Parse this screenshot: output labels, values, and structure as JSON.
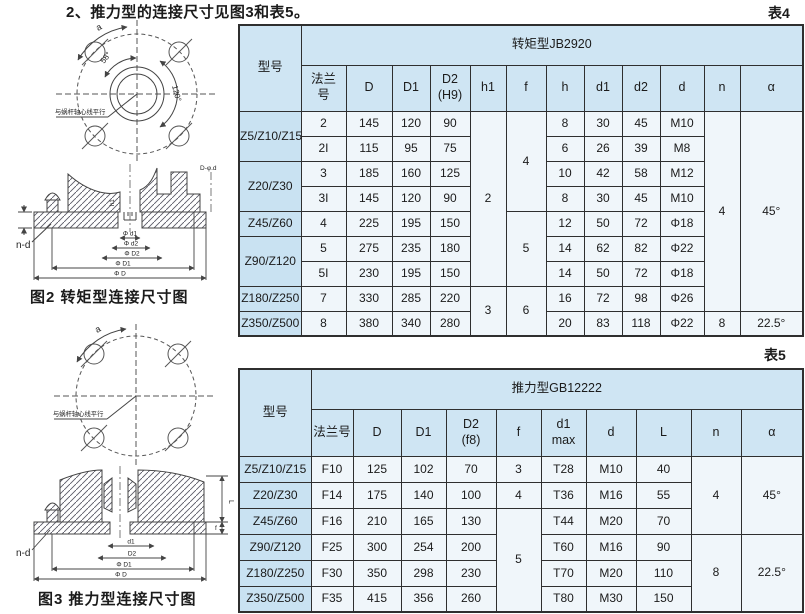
{
  "page": {
    "title": "2、推力型的连接尺寸见图3和表5。",
    "table4_tag": "表4",
    "table5_tag": "表5"
  },
  "colors": {
    "header_bg": "#cfe5f3",
    "model_col_bg": "#c9e2f2",
    "cell_bg": "#f0f6fa",
    "border": "#2f2f2f"
  },
  "figures": {
    "fig2_caption": "图2 转矩型连接尺寸图",
    "fig3_caption": "图3 推力型连接尺寸图",
    "circle_labels": {
      "a": "a",
      "deg58": "58°",
      "deg120": "120°",
      "parallel": "与蜗杆轴心线平行"
    },
    "fig2_labels": {
      "nd": "n-d",
      "h1": "h1",
      "dphid": "D-φ.d",
      "dims": [
        "Φ d1",
        "Φ d2",
        "Φ D2",
        "Φ D1",
        "Φ D"
      ]
    },
    "fig3_labels": {
      "nd": "n-d",
      "L": "L",
      "f": "f",
      "dims": [
        "d1",
        "D2",
        "Φ D1",
        "Φ D"
      ]
    }
  },
  "table4": {
    "group_header": "转矩型JB2920",
    "rows": [
      [
        {
          "t": "型号",
          "rs": 2,
          "c": "h"
        },
        {
          "t": "转矩型JB2920",
          "cs": 12,
          "c": "h"
        }
      ],
      [
        {
          "t": "法兰\n号",
          "c": "h"
        },
        {
          "t": "D",
          "c": "h"
        },
        {
          "t": "D1",
          "c": "h"
        },
        {
          "t": "D2\n(H9)",
          "c": "h"
        },
        {
          "t": "h1",
          "c": "h"
        },
        {
          "t": "f",
          "c": "h"
        },
        {
          "t": "h",
          "c": "h"
        },
        {
          "t": "d1",
          "c": "h"
        },
        {
          "t": "d2",
          "c": "h"
        },
        {
          "t": "d",
          "c": "h"
        },
        {
          "t": "n",
          "c": "h"
        },
        {
          "t": "α",
          "c": "h"
        }
      ],
      [
        {
          "t": "Z5/Z10/Z15",
          "rs": 2,
          "c": "m"
        },
        {
          "t": "2"
        },
        {
          "t": "145"
        },
        {
          "t": "120"
        },
        {
          "t": "90"
        },
        {
          "t": "2",
          "rs": 7
        },
        {
          "t": "4",
          "rs": 4
        },
        {
          "t": "8"
        },
        {
          "t": "30"
        },
        {
          "t": "45"
        },
        {
          "t": "M10"
        },
        {
          "t": "4",
          "rs": 8
        },
        {
          "t": "45°",
          "rs": 8
        }
      ],
      [
        {
          "t": "2I"
        },
        {
          "t": "115"
        },
        {
          "t": "95"
        },
        {
          "t": "75"
        },
        {
          "t": "6"
        },
        {
          "t": "26"
        },
        {
          "t": "39"
        },
        {
          "t": "M8"
        }
      ],
      [
        {
          "t": "Z20/Z30",
          "rs": 2,
          "c": "m"
        },
        {
          "t": "3"
        },
        {
          "t": "185"
        },
        {
          "t": "160"
        },
        {
          "t": "125"
        },
        {
          "t": "10"
        },
        {
          "t": "42"
        },
        {
          "t": "58"
        },
        {
          "t": "M12"
        }
      ],
      [
        {
          "t": "3I"
        },
        {
          "t": "145"
        },
        {
          "t": "120"
        },
        {
          "t": "90"
        },
        {
          "t": "8"
        },
        {
          "t": "30"
        },
        {
          "t": "45"
        },
        {
          "t": "M10"
        }
      ],
      [
        {
          "t": "Z45/Z60",
          "c": "m"
        },
        {
          "t": "4"
        },
        {
          "t": "225"
        },
        {
          "t": "195"
        },
        {
          "t": "150"
        },
        {
          "t": "5",
          "rs": 3
        },
        {
          "t": "12"
        },
        {
          "t": "50"
        },
        {
          "t": "72"
        },
        {
          "t": "Φ18"
        }
      ],
      [
        {
          "t": "Z90/Z120",
          "rs": 2,
          "c": "m"
        },
        {
          "t": "5"
        },
        {
          "t": "275"
        },
        {
          "t": "235"
        },
        {
          "t": "180"
        },
        {
          "t": "14"
        },
        {
          "t": "62"
        },
        {
          "t": "82"
        },
        {
          "t": "Φ22"
        }
      ],
      [
        {
          "t": "5I"
        },
        {
          "t": "230"
        },
        {
          "t": "195"
        },
        {
          "t": "150"
        },
        {
          "t": "14"
        },
        {
          "t": "50"
        },
        {
          "t": "72"
        },
        {
          "t": "Φ18"
        }
      ],
      [
        {
          "t": "Z180/Z250",
          "c": "m"
        },
        {
          "t": "7"
        },
        {
          "t": "330"
        },
        {
          "t": "285"
        },
        {
          "t": "220"
        },
        {
          "t": "3",
          "rs": 2
        },
        {
          "t": "6",
          "rs": 2
        },
        {
          "t": "16"
        },
        {
          "t": "72"
        },
        {
          "t": "98"
        },
        {
          "t": "Φ26"
        }
      ],
      [
        {
          "t": "Z350/Z500",
          "c": "m"
        },
        {
          "t": "8"
        },
        {
          "t": "380"
        },
        {
          "t": "340"
        },
        {
          "t": "280"
        },
        {
          "t": "20"
        },
        {
          "t": "83"
        },
        {
          "t": "118"
        },
        {
          "t": "Φ22"
        },
        {
          "t": "8"
        },
        {
          "t": "22.5°"
        }
      ]
    ]
  },
  "table5": {
    "group_header": "推力型GB12222",
    "rows": [
      [
        {
          "t": "型号",
          "rs": 2,
          "c": "h"
        },
        {
          "t": "推力型GB12222",
          "cs": 10,
          "c": "h"
        }
      ],
      [
        {
          "t": "法兰号",
          "c": "h"
        },
        {
          "t": "D",
          "c": "h"
        },
        {
          "t": "D1",
          "c": "h"
        },
        {
          "t": "D2\n(f8)",
          "c": "h"
        },
        {
          "t": "f",
          "c": "h"
        },
        {
          "t": "d1\nmax",
          "c": "h"
        },
        {
          "t": "d",
          "c": "h"
        },
        {
          "t": "L",
          "c": "h"
        },
        {
          "t": "n",
          "c": "h"
        },
        {
          "t": "α",
          "c": "h"
        }
      ],
      [
        {
          "t": "Z5/Z10/Z15",
          "c": "m"
        },
        {
          "t": "F10"
        },
        {
          "t": "125"
        },
        {
          "t": "102"
        },
        {
          "t": "70"
        },
        {
          "t": "3"
        },
        {
          "t": "T28"
        },
        {
          "t": "M10"
        },
        {
          "t": "40"
        },
        {
          "t": "4",
          "rs": 3
        },
        {
          "t": "45°",
          "rs": 3
        }
      ],
      [
        {
          "t": "Z20/Z30",
          "c": "m"
        },
        {
          "t": "F14"
        },
        {
          "t": "175"
        },
        {
          "t": "140"
        },
        {
          "t": "100"
        },
        {
          "t": "4"
        },
        {
          "t": "T36"
        },
        {
          "t": "M16"
        },
        {
          "t": "55"
        }
      ],
      [
        {
          "t": "Z45/Z60",
          "c": "m"
        },
        {
          "t": "F16"
        },
        {
          "t": "210"
        },
        {
          "t": "165"
        },
        {
          "t": "130"
        },
        {
          "t": "5",
          "rs": 4
        },
        {
          "t": "T44"
        },
        {
          "t": "M20"
        },
        {
          "t": "70"
        }
      ],
      [
        {
          "t": "Z90/Z120",
          "c": "m"
        },
        {
          "t": "F25"
        },
        {
          "t": "300"
        },
        {
          "t": "254"
        },
        {
          "t": "200"
        },
        {
          "t": "T60"
        },
        {
          "t": "M16"
        },
        {
          "t": "90"
        },
        {
          "t": "8",
          "rs": 3
        },
        {
          "t": "22.5°",
          "rs": 3
        }
      ],
      [
        {
          "t": "Z180/Z250",
          "c": "m"
        },
        {
          "t": "F30"
        },
        {
          "t": "350"
        },
        {
          "t": "298"
        },
        {
          "t": "230"
        },
        {
          "t": "T70"
        },
        {
          "t": "M20"
        },
        {
          "t": "110"
        }
      ],
      [
        {
          "t": "Z350/Z500",
          "c": "m"
        },
        {
          "t": "F35"
        },
        {
          "t": "415"
        },
        {
          "t": "356"
        },
        {
          "t": "260"
        },
        {
          "t": "T80"
        },
        {
          "t": "M30"
        },
        {
          "t": "150"
        }
      ]
    ]
  }
}
